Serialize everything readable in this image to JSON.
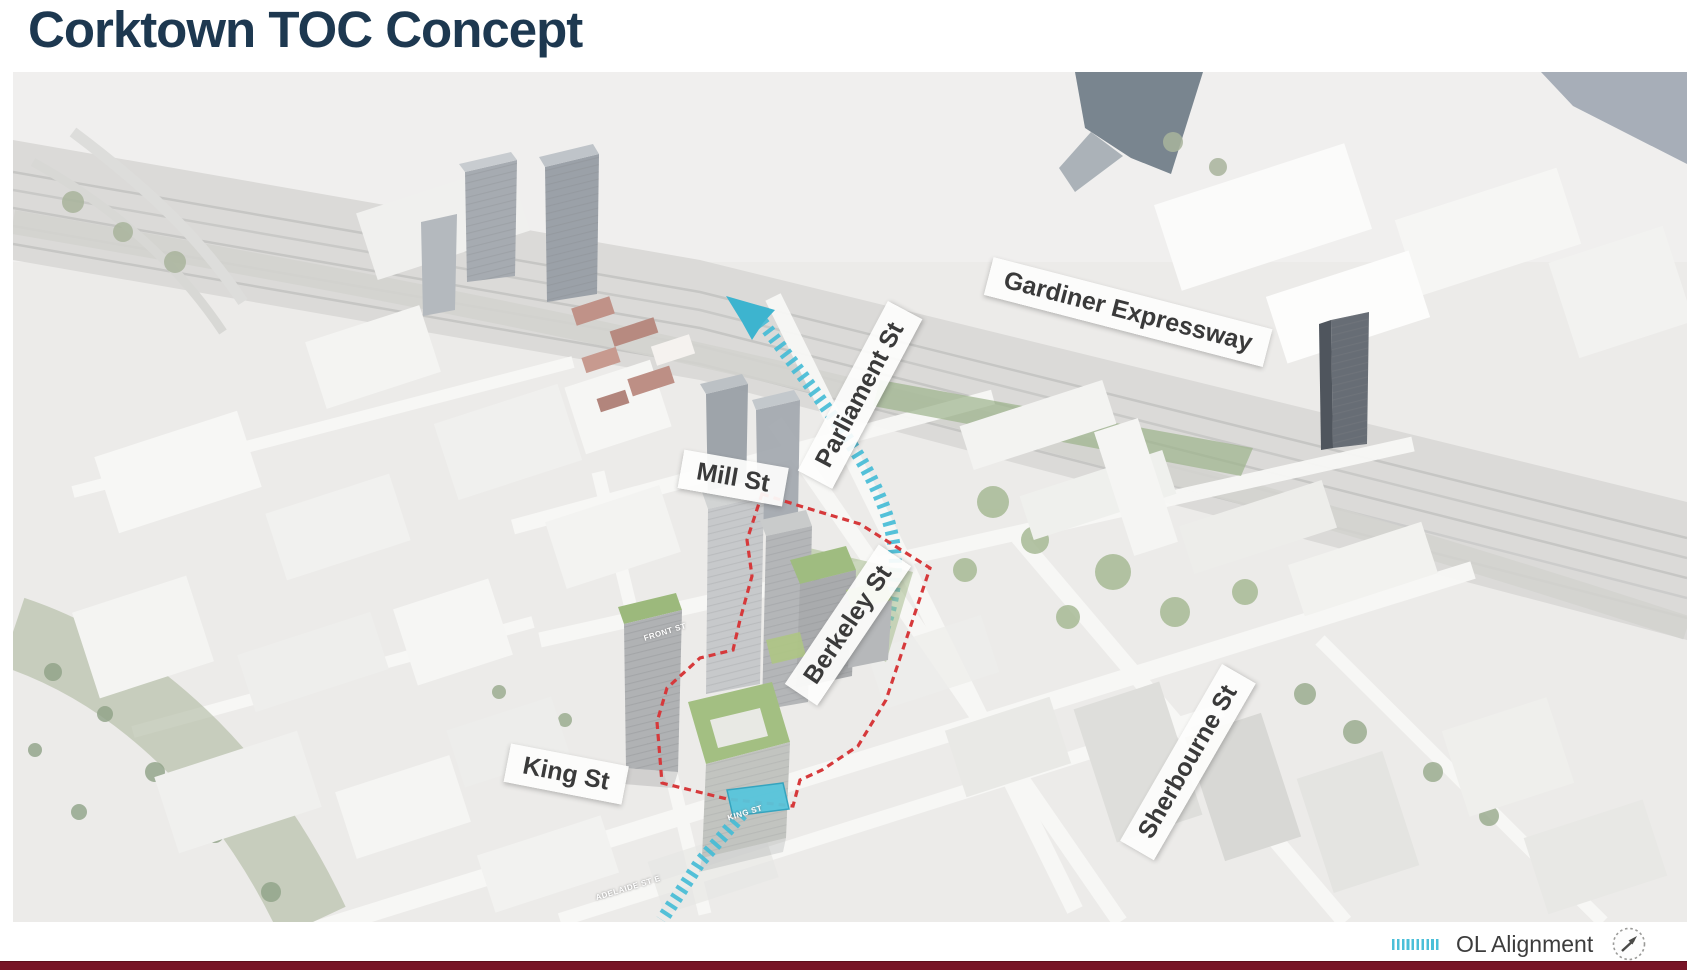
{
  "title": "Corktown TOC Concept",
  "map": {
    "street_labels": [
      {
        "id": "gardiner",
        "text": "Gardiner Expressway"
      },
      {
        "id": "parliament",
        "text": "Parliament St"
      },
      {
        "id": "mill",
        "text": "Mill St"
      },
      {
        "id": "berkeley",
        "text": "Berkeley St"
      },
      {
        "id": "king",
        "text": "King St"
      },
      {
        "id": "sherbourne",
        "text": "Sherbourne St"
      }
    ],
    "micro_labels": [
      {
        "text": "FRONT ST"
      },
      {
        "text": "KING ST"
      },
      {
        "text": "ADELAIDE ST E"
      }
    ],
    "annotations": {
      "ol_line_color": "#4bbfd8",
      "site_boundary_color": "#d6393b"
    }
  },
  "legend": {
    "ol_alignment_label": "OL Alignment"
  },
  "colors": {
    "title_navy": "#1d3850",
    "accent_cyan": "#4bbfd8",
    "boundary_red": "#d6393b",
    "footer_maroon": "#771426"
  }
}
